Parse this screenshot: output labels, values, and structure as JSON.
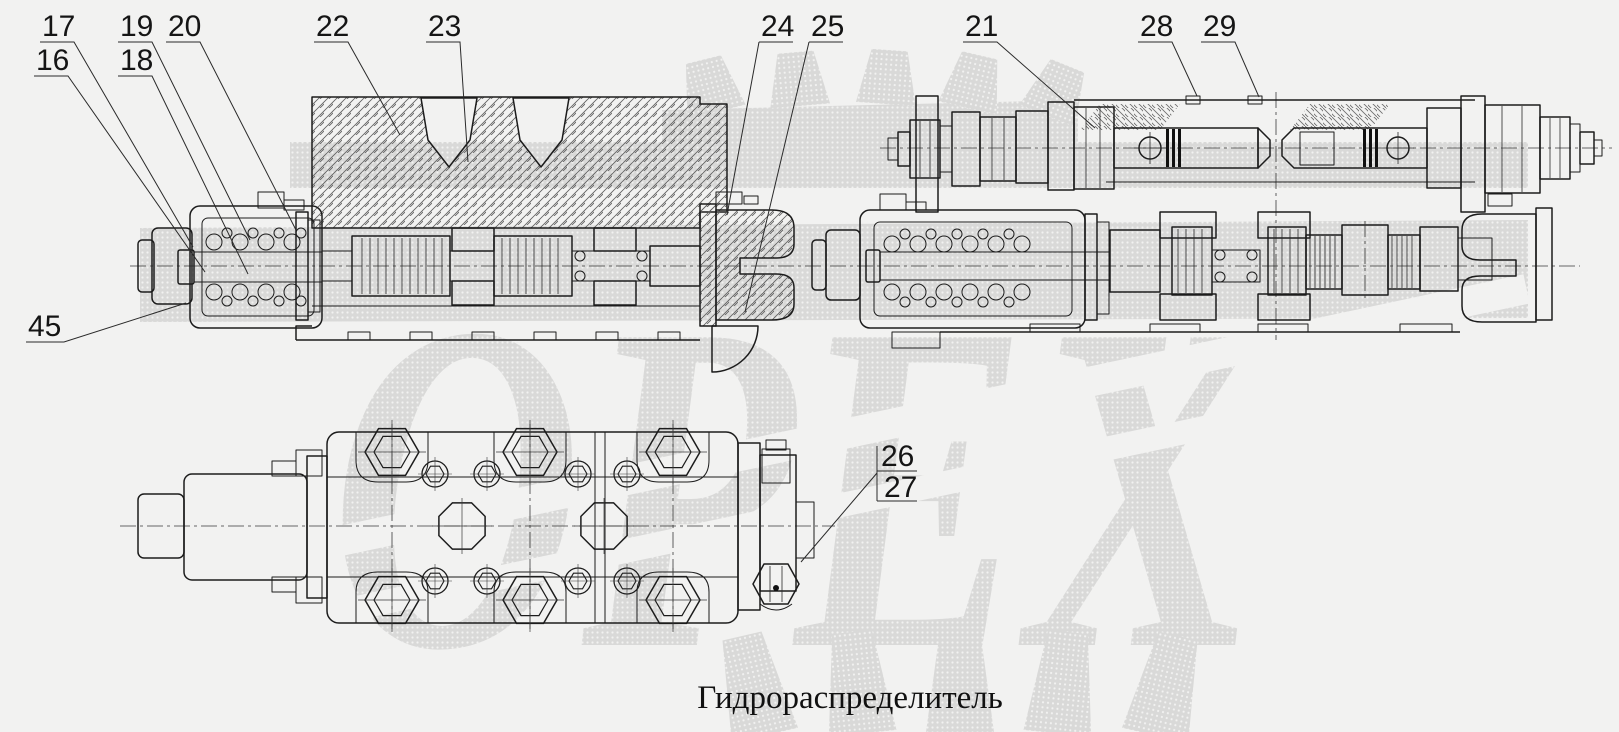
{
  "figure": {
    "caption": "Гидрораспределитель",
    "watermark_text": "ОРЕХ"
  },
  "labels": {
    "n16": "16",
    "n17": "17",
    "n18": "18",
    "n19": "19",
    "n20": "20",
    "n21": "21",
    "n22": "22",
    "n23": "23",
    "n24": "24",
    "n25": "25",
    "n26": "26",
    "n27": "27",
    "n28": "28",
    "n29": "29",
    "n45": "45"
  }
}
